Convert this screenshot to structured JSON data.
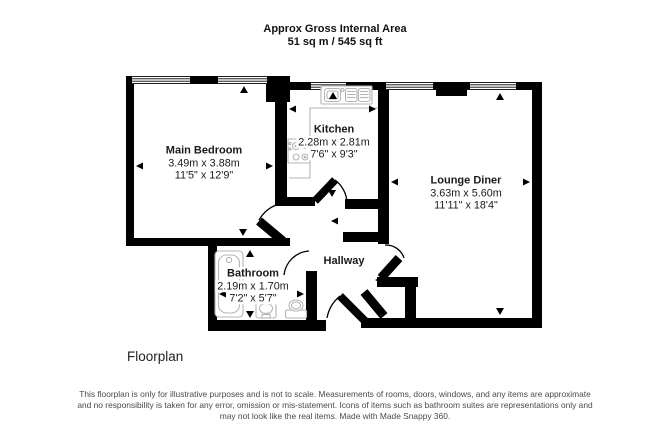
{
  "header": {
    "line1": "Approx Gross Internal Area",
    "line2": "51 sq m / 545 sq ft"
  },
  "rooms": {
    "main_bedroom": {
      "name": "Main Bedroom",
      "metric": "3.49m x 3.88m",
      "imperial": "11'5\" x 12'9\""
    },
    "kitchen": {
      "name": "Kitchen",
      "metric": "2.28m x 2.81m",
      "imperial": "7'6\" x 9'3\""
    },
    "lounge_diner": {
      "name": "Lounge Diner",
      "metric": "3.63m x 5.60m",
      "imperial": "11'11\" x 18'4\""
    },
    "bathroom": {
      "name": "Bathroom",
      "metric": "2.19m x 1.70m",
      "imperial": "7'2\" x 5'7\""
    },
    "hallway": {
      "name": "Hallway"
    }
  },
  "footer": {
    "plan_label": "Floorplan"
  },
  "disclaimer": {
    "line1": "This floorplan is only for illustrative purposes and is not to scale. Measurements of rooms, doors, windows, and any items are approximate",
    "line2": "and no responsibility is taken for any error, omission or mis-statement. Icons of items such as bathroom suites are representations only and",
    "line3": "may not look like the real items. Made with Made Snappy 360."
  },
  "fixtures": [
    "bathtub",
    "basin",
    "toilet",
    "sink-drainer",
    "stove",
    "kitchen-counter"
  ],
  "colors": {
    "wall": "#000000",
    "background": "#ffffff",
    "fixture_outline": "#b5b5b5",
    "room_text": "#1a1a1a",
    "disclaimer_text": "#4a4a4a"
  }
}
